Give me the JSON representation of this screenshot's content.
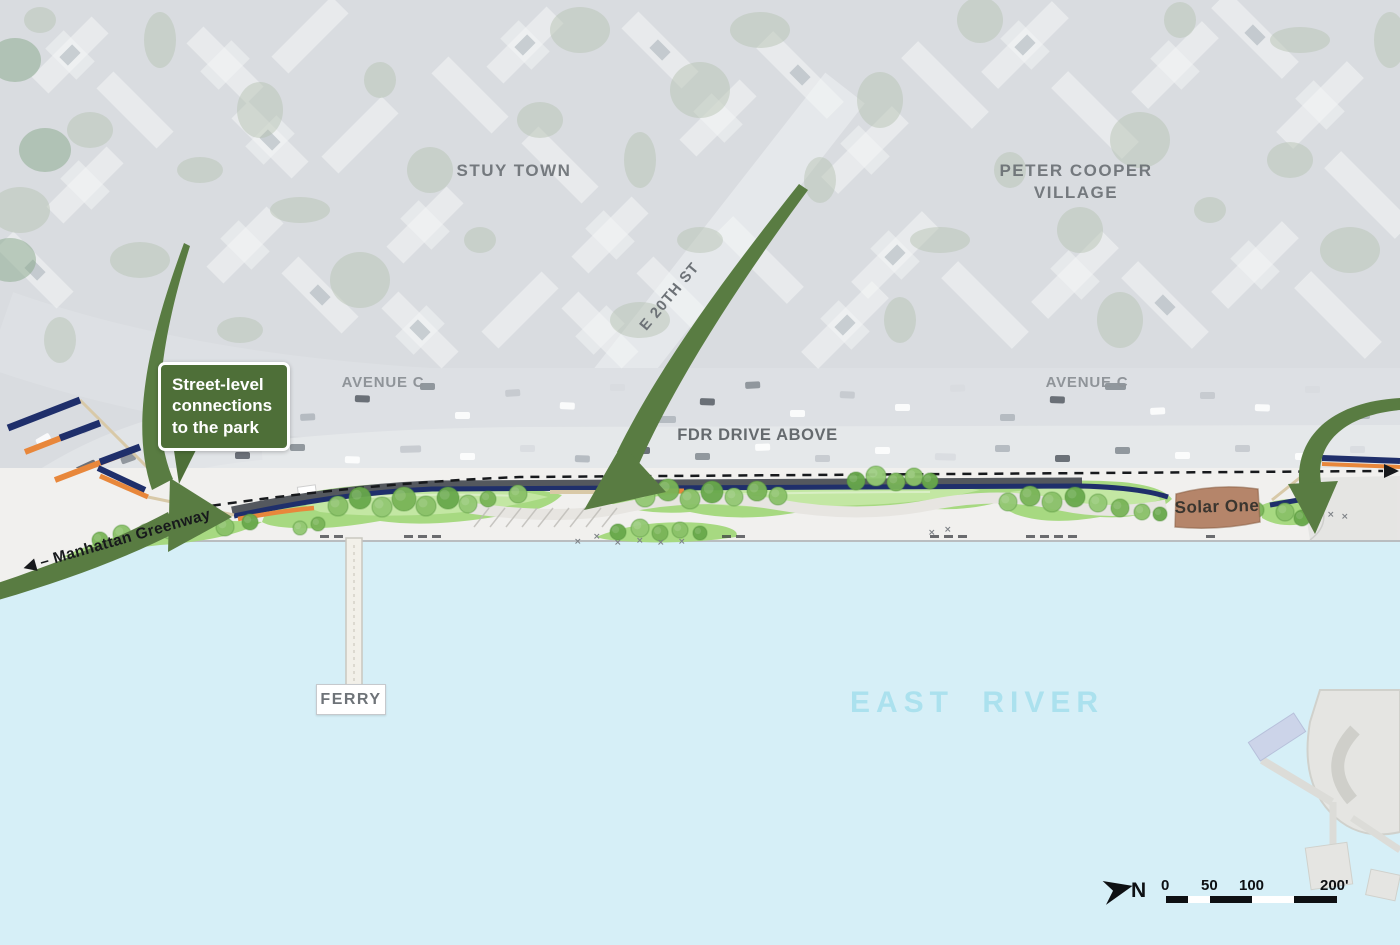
{
  "labels": {
    "stuy_town": "STUY TOWN",
    "peter_cooper_village": "PETER COOPER\nVILLAGE",
    "avenue_c_west": "AVENUE C",
    "avenue_c_east": "AVENUE C",
    "e_20th_st": "E 20TH ST",
    "fdr_drive": "FDR DRIVE ABOVE",
    "manhattan_greenway": "◀ – Manhattan Greenway",
    "east_river": "EAST RIVER",
    "ferry": "FERRY",
    "solar_one": "Solar One"
  },
  "callout": {
    "text": "Street-level\nconnections\nto the park"
  },
  "legend": {
    "north": "N",
    "scale_ticks": [
      "0",
      "50",
      "100",
      "200'"
    ]
  },
  "colors": {
    "arrow_green": "#597c42",
    "callout_green": "#4e6f38",
    "water": "#d6eff7",
    "greenway_navy": "#1f2f6b",
    "ramp_orange": "#e8873b",
    "lawn_green": "#a7d981",
    "east_river_text": "#abe1ee",
    "solar_one_brown": "#b5856a"
  }
}
